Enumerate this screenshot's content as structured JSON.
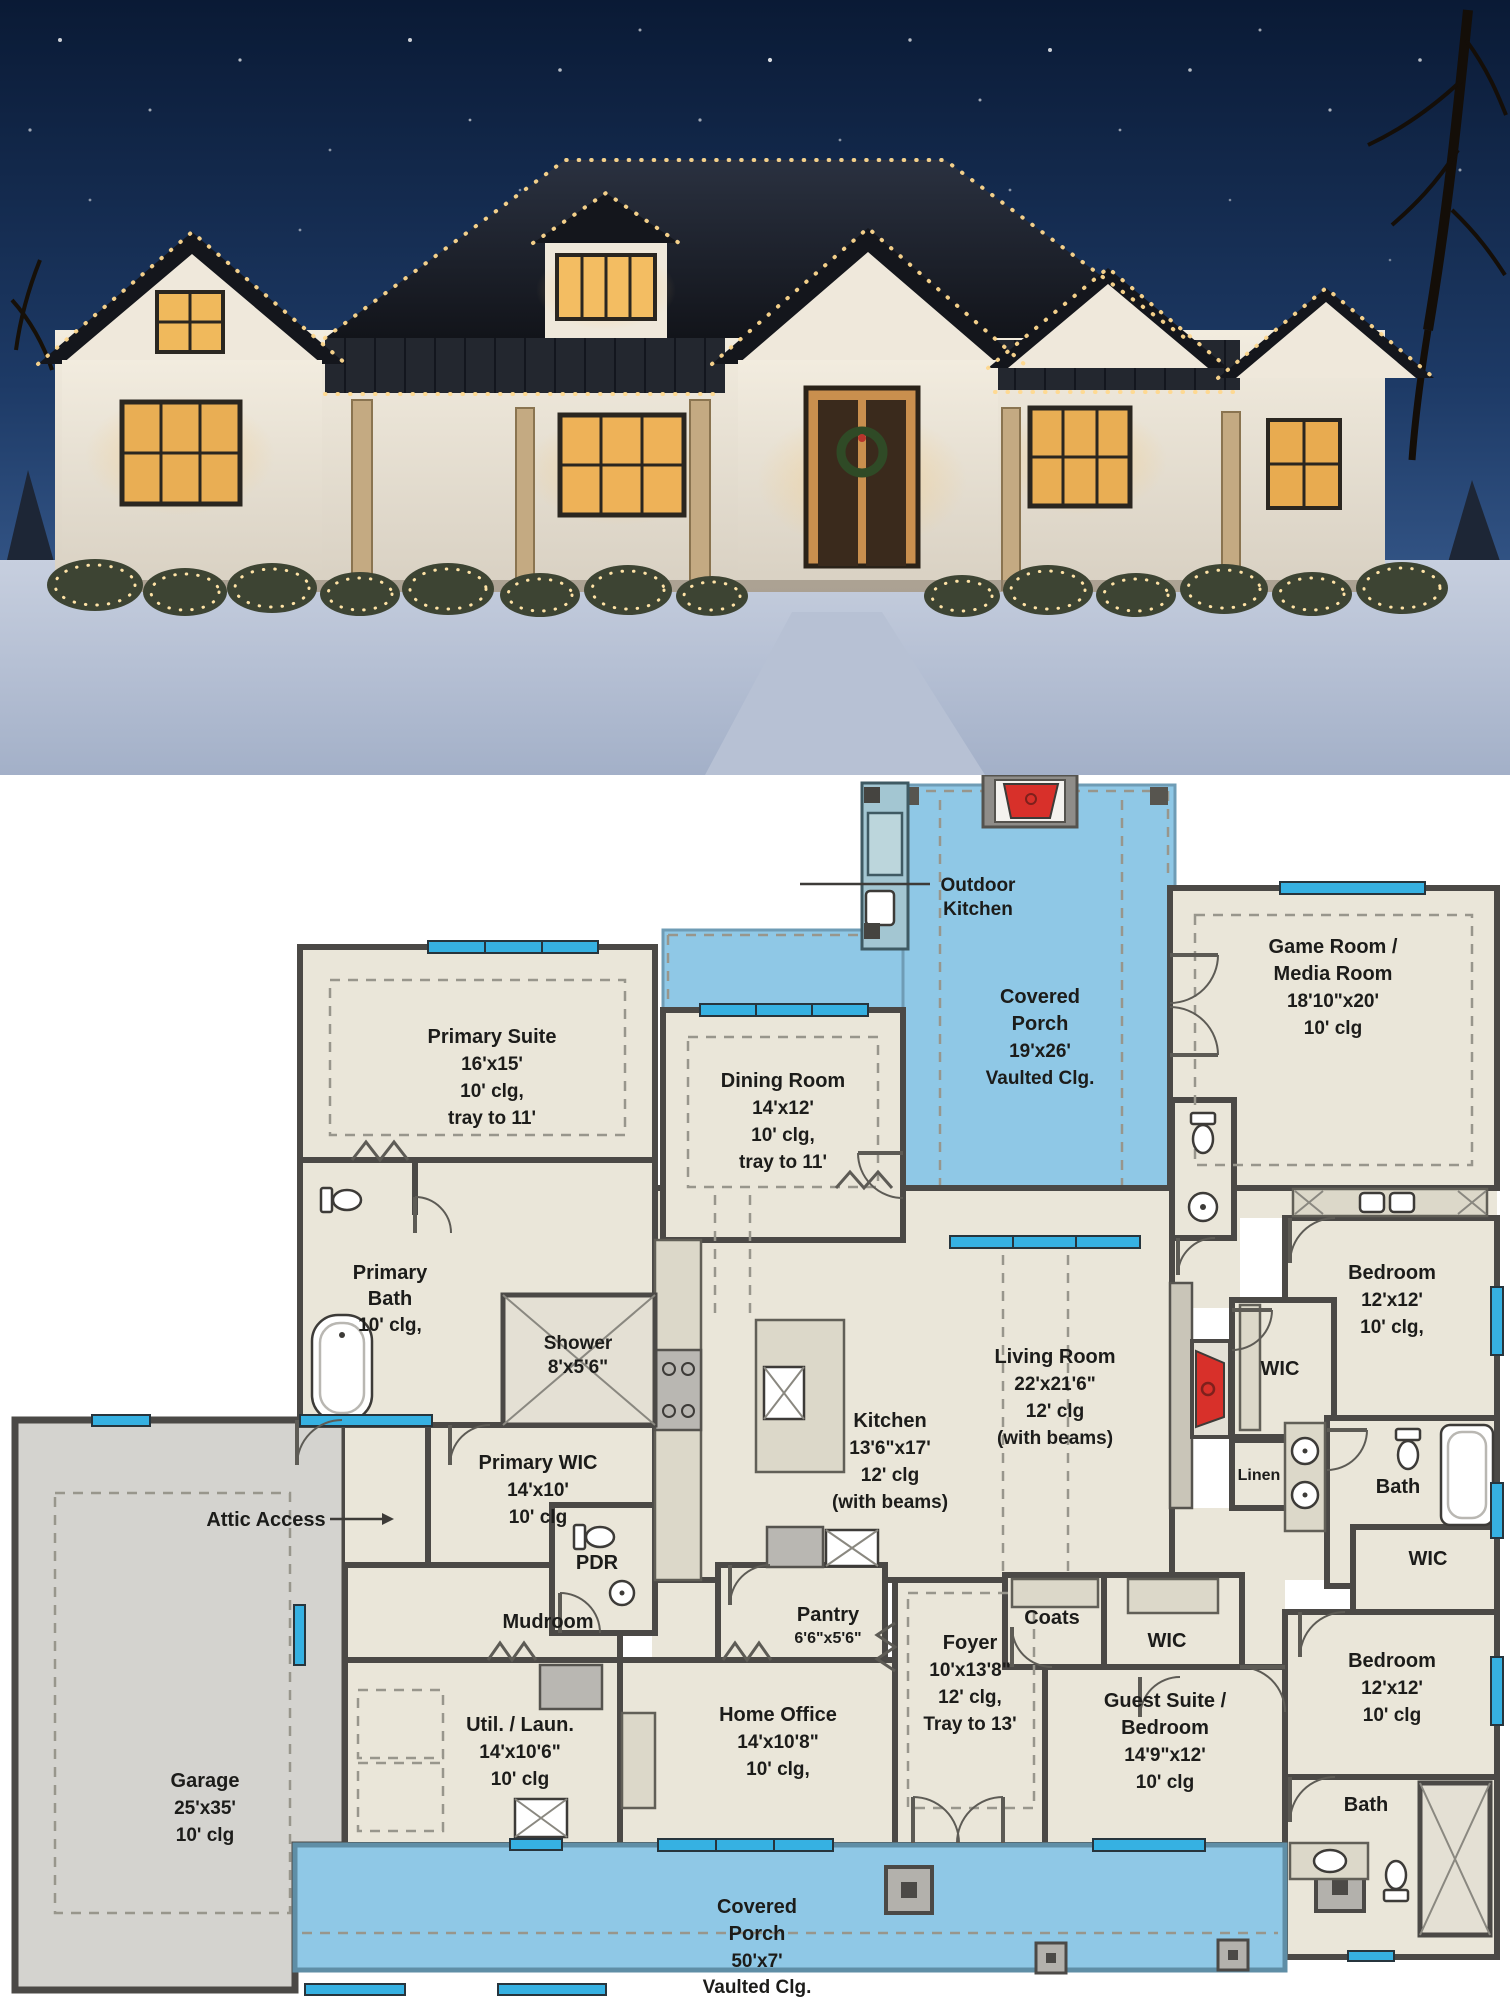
{
  "palette": {
    "ink": "#1c1c1a",
    "wall": "#4b4946",
    "wallLight": "#979590",
    "floor": "#eae6d9",
    "garage": "#d4d3cf",
    "porch": "#8fc8e6",
    "counter": "#dcd8c9",
    "counterBlue": "#a3c6d2",
    "window": "#36b1e2",
    "red": "#d8302a",
    "dash": "#98968c",
    "skyTop": "#0a1a35",
    "skyLow": "#2c4f83",
    "snow": "#b6c1d5",
    "houseWall": "#ece6da",
    "roof": "#181b22",
    "lights": "#ffd98f",
    "windowGlow": "#f0b95c",
    "bush": "#3d4433"
  },
  "rooms": {
    "primary_suite": [
      "Primary Suite",
      "16'x15'",
      "10' clg,",
      "tray to 11'"
    ],
    "dining_room": [
      "Dining Room",
      "14'x12'",
      "10' clg,",
      "tray to 11'"
    ],
    "covered_porch_rear": [
      "Covered",
      "Porch",
      "19'x26'",
      "Vaulted Clg."
    ],
    "outdoor_kitchen": [
      "Outdoor",
      "Kitchen"
    ],
    "game_room": [
      "Game Room /",
      "Media Room",
      "18'10\"x20'",
      "10' clg"
    ],
    "primary_bath": [
      "Primary",
      "Bath",
      "10' clg,"
    ],
    "shower": [
      "Shower",
      "8'x5'6\""
    ],
    "bedroom_1": [
      "Bedroom",
      "12'x12'",
      "10' clg,"
    ],
    "living_room": [
      "Living Room",
      "22'x21'6\"",
      "12' clg",
      "(with beams)"
    ],
    "kitchen": [
      "Kitchen",
      "13'6\"x17'",
      "12' clg",
      "(with beams)"
    ],
    "wic_1": [
      "WIC"
    ],
    "linen": [
      "Linen"
    ],
    "bath_middle": [
      "Bath"
    ],
    "wic_2": [
      "WIC"
    ],
    "bedroom_2": [
      "Bedroom",
      "12'x12'",
      "10' clg"
    ],
    "bath_bottom": [
      "Bath"
    ],
    "coats": [
      "Coats"
    ],
    "wic_3": [
      "WIC"
    ],
    "guest_suite": [
      "Guest Suite /",
      "Bedroom",
      "14'9\"x12'",
      "10' clg"
    ],
    "foyer": [
      "Foyer",
      "10'x13'8\"",
      "12' clg,",
      "Tray to 13'"
    ],
    "mudroom": [
      "Mudroom"
    ],
    "util_laun": [
      "Util. / Laun.",
      "14'x10'6\"",
      "10' clg"
    ],
    "home_office": [
      "Home Office",
      "14'x10'8\"",
      "10' clg,"
    ],
    "pantry": [
      "Pantry",
      "6'6\"x5'6\""
    ],
    "pdr": [
      "PDR"
    ],
    "primary_wic": [
      "Primary WIC",
      "14'x10'",
      "10' clg"
    ],
    "attic_access": [
      "Attic Access"
    ],
    "garage": [
      "Garage",
      "25'x35'",
      "10' clg"
    ],
    "covered_porch_front": [
      "Covered",
      "Porch",
      "50'x7'",
      "Vaulted Clg."
    ]
  }
}
